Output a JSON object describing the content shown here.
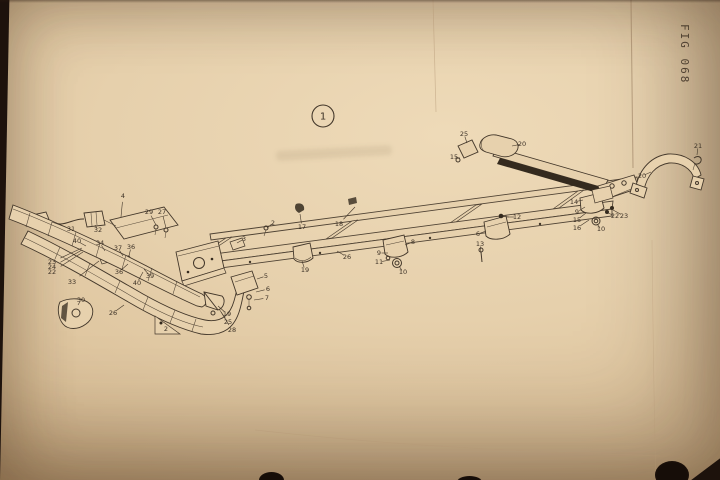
{
  "page": {
    "fig_label": "FIG 068"
  },
  "colors": {
    "backdrop": "#1d120c",
    "paper": "#e6d0ac",
    "ink": "#43372a",
    "crease": "#b59876"
  },
  "diagram": {
    "assembly_callout": {
      "label": "1",
      "x": 323,
      "y": 116,
      "r": 11
    },
    "callouts": [
      {
        "n": "4",
        "x": 123,
        "y": 196,
        "lx": 121,
        "ly": 217
      },
      {
        "n": "29",
        "x": 149,
        "y": 212,
        "lx": 156,
        "ly": 225
      },
      {
        "n": "27",
        "x": 162,
        "y": 212,
        "lx": 166,
        "ly": 228
      },
      {
        "n": "31",
        "x": 71,
        "y": 229,
        "lx": 52,
        "ly": 222
      },
      {
        "n": "32",
        "x": 98,
        "y": 230,
        "lx": 95,
        "ly": 225
      },
      {
        "n": "40",
        "x": 77,
        "y": 241,
        "lx": 86,
        "ly": 246
      },
      {
        "n": "34",
        "x": 100,
        "y": 243,
        "lx": 105,
        "ly": 251
      },
      {
        "n": "37",
        "x": 118,
        "y": 248,
        "lx": 123,
        "ly": 256
      },
      {
        "n": "36",
        "x": 131,
        "y": 247,
        "lx": 129,
        "ly": 256
      },
      {
        "n": "23",
        "x": 52,
        "y": 262,
        "lx": 82,
        "ly": 248
      },
      {
        "n": "24",
        "x": 52,
        "y": 267,
        "lx": 82,
        "ly": 250
      },
      {
        "n": "22",
        "x": 52,
        "y": 272,
        "lx": 83,
        "ly": 252
      },
      {
        "n": "33",
        "x": 72,
        "y": 282,
        "lx": 99,
        "ly": 261
      },
      {
        "n": "30",
        "x": 81,
        "y": 300,
        "lx": 78,
        "ly": 305
      },
      {
        "n": "26",
        "x": 113,
        "y": 313,
        "lx": 124,
        "ly": 305
      },
      {
        "n": "36",
        "x": 119,
        "y": 272,
        "lx": 128,
        "ly": 264
      },
      {
        "n": "39",
        "x": 150,
        "y": 276,
        "lx": 144,
        "ly": 269
      },
      {
        "n": "40",
        "x": 137,
        "y": 283,
        "lx": 143,
        "ly": 272
      },
      {
        "n": "2",
        "x": 166,
        "y": 329
      },
      {
        "n": "19",
        "x": 227,
        "y": 314,
        "lx": 218,
        "ly": 306
      },
      {
        "n": "25",
        "x": 228,
        "y": 322,
        "lx": 219,
        "ly": 309
      },
      {
        "n": "28",
        "x": 232,
        "y": 330,
        "lx": 221,
        "ly": 312
      },
      {
        "n": "5",
        "x": 266,
        "y": 276,
        "lx": 257,
        "ly": 279
      },
      {
        "n": "6",
        "x": 268,
        "y": 289,
        "lx": 256,
        "ly": 292
      },
      {
        "n": "7",
        "x": 267,
        "y": 298,
        "lx": 254,
        "ly": 300
      },
      {
        "n": "3",
        "x": 244,
        "y": 239,
        "lx": 237,
        "ly": 243
      },
      {
        "n": "2",
        "x": 273,
        "y": 223,
        "lx": 267,
        "ly": 228
      },
      {
        "n": "17",
        "x": 302,
        "y": 227,
        "lx": 300,
        "ly": 214
      },
      {
        "n": "18",
        "x": 339,
        "y": 224,
        "lx": 355,
        "ly": 207
      },
      {
        "n": "19",
        "x": 305,
        "y": 270,
        "lx": 302,
        "ly": 261
      },
      {
        "n": "26",
        "x": 347,
        "y": 257,
        "lx": 337,
        "ly": 251
      },
      {
        "n": "8",
        "x": 413,
        "y": 242,
        "lx": 405,
        "ly": 245
      },
      {
        "n": "9",
        "x": 379,
        "y": 253,
        "lx": 388,
        "ly": 253
      },
      {
        "n": "11",
        "x": 379,
        "y": 262,
        "lx": 390,
        "ly": 260
      },
      {
        "n": "10",
        "x": 403,
        "y": 272,
        "lx": 399,
        "ly": 266
      },
      {
        "n": "6",
        "x": 478,
        "y": 234,
        "lx": 486,
        "ly": 231
      },
      {
        "n": "13",
        "x": 480,
        "y": 244,
        "lx": 481,
        "ly": 253
      },
      {
        "n": "12",
        "x": 517,
        "y": 217,
        "lx": 506,
        "ly": 217
      },
      {
        "n": "25",
        "x": 464,
        "y": 134,
        "lx": 467,
        "ly": 143
      },
      {
        "n": "20",
        "x": 522,
        "y": 144,
        "lx": 512,
        "ly": 146
      },
      {
        "n": "15",
        "x": 454,
        "y": 157,
        "lx": 460,
        "ly": 158
      },
      {
        "n": "14",
        "x": 574,
        "y": 202,
        "lx": 583,
        "ly": 200
      },
      {
        "n": "9",
        "x": 577,
        "y": 212,
        "lx": 585,
        "ly": 207
      },
      {
        "n": "15",
        "x": 577,
        "y": 220,
        "lx": 586,
        "ly": 213
      },
      {
        "n": "16",
        "x": 577,
        "y": 228,
        "lx": 589,
        "ly": 220
      },
      {
        "n": "10",
        "x": 601,
        "y": 229,
        "lx": 597,
        "ly": 224
      },
      {
        "n": "22",
        "x": 615,
        "y": 216,
        "lx": 608,
        "ly": 213
      },
      {
        "n": "23",
        "x": 624,
        "y": 216,
        "lx": 613,
        "ly": 210
      },
      {
        "n": "20",
        "x": 642,
        "y": 176,
        "lx": 651,
        "ly": 172
      },
      {
        "n": "21",
        "x": 698,
        "y": 146,
        "lx": 697,
        "ly": 155
      }
    ]
  }
}
